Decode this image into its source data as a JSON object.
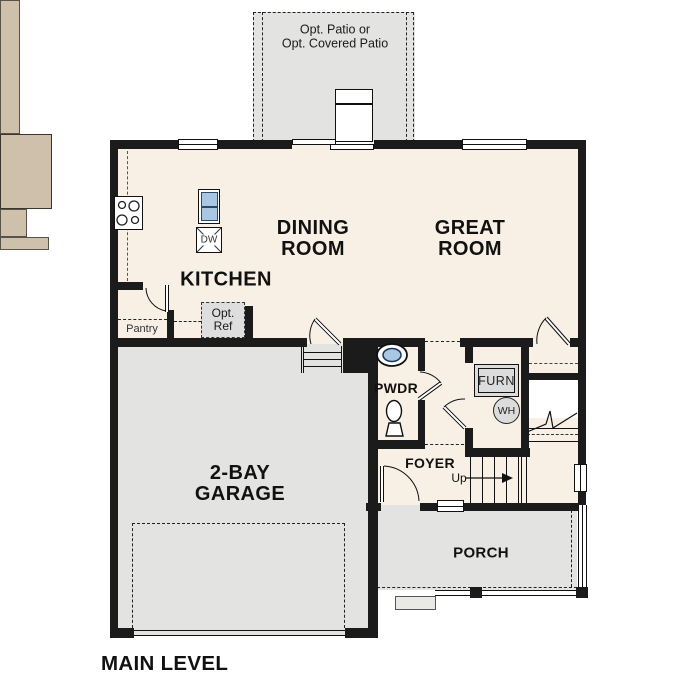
{
  "colors": {
    "wall": "#1b1b1b",
    "floor": "#f8f0e4",
    "counter": "#cfc0ab",
    "concrete": "#e3e3e1",
    "fixture": "#dcdcdc",
    "sink": "#a9c6e2",
    "text": "#111111"
  },
  "plan": {
    "level_title": "MAIN LEVEL",
    "patio": {
      "line1": "Opt. Patio or",
      "line2": "Opt. Covered Patio"
    },
    "dining": {
      "line1": "DINING",
      "line2": "ROOM"
    },
    "great": {
      "line1": "GREAT",
      "line2": "ROOM"
    },
    "kitchen": {
      "label": "KITCHEN"
    },
    "pantry": {
      "label": "Pantry"
    },
    "opt_ref": {
      "line1": "Opt.",
      "line2": "Ref"
    },
    "island": {
      "dishwasher": "DW"
    },
    "powder": {
      "label": "PWDR"
    },
    "furnace": {
      "label": "FURN"
    },
    "water_heater": {
      "label": "WH"
    },
    "foyer": {
      "label": "FOYER"
    },
    "stairs": {
      "up": "Up"
    },
    "garage": {
      "line1": "2-BAY",
      "line2": "GARAGE"
    },
    "porch": {
      "label": "PORCH"
    }
  }
}
